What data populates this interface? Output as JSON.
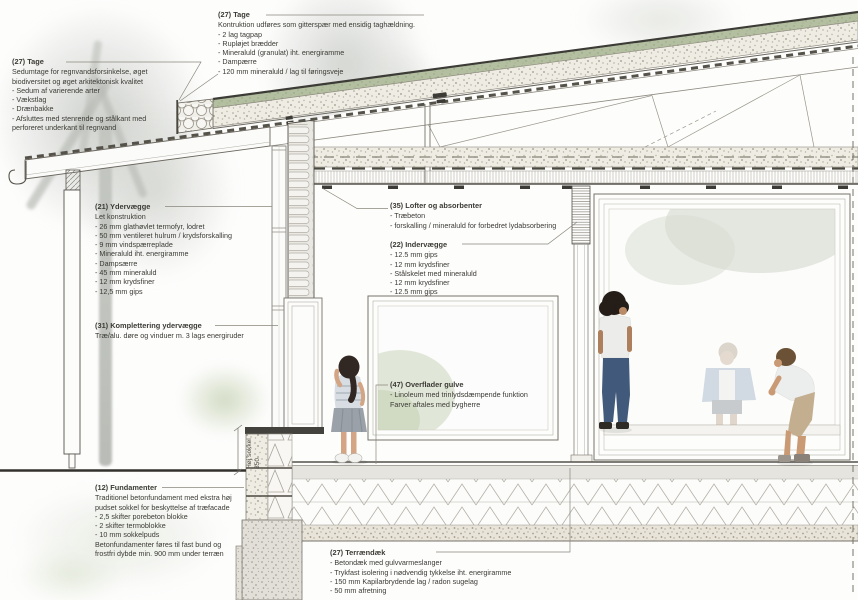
{
  "meta": {
    "drawing_type": "architectural facade section detail",
    "language": "da"
  },
  "palette": {
    "line_dark": "#55524a",
    "sedum_green": "#b3bfa0",
    "insulation_beige": "#efece3",
    "concrete_gray": "#e2dfd8",
    "watercolor_gray": "#c6c9c4",
    "foliage_green": "#ccd6bb",
    "denim_blue": "#41597a"
  },
  "annotations": {
    "tage_construction": {
      "title": "(27) Tage",
      "body": "Kontruktion udføres som gitterspær med ensidig taghældning.\n- 2 lag tagpap\n- Rupløjet brædder\n- Mineraluld (granulat) iht. energiramme\n- Dampærre\n- 120 mm mineraluld / lag til føringsveje"
    },
    "tage_sedum": {
      "title": "(27) Tage",
      "body": "Sedumtage for regnvandsforsinkelse, øget\nbiodiversitet og øget arkitektonisk kvalitet\n- Sedum af varierende arter\n- Vækstlag\n- Drænbakke\n- Afsluttes med stenrende og stålkant med\nperforeret underkant til regnvand"
    },
    "ydervaegge": {
      "title": "(21) Ydervægge",
      "body": "Let konstruktion\n- 26 mm glathøvlet termofyr, lodret\n- 50 mm ventileret hulrum / krydsforskalling\n- 9 mm vindspærreplade\n- Mineraluld iht. energiramme\n- Dampsærre\n- 45 mm mineraluld\n- 12 mm krydsfiner\n- 12,5 mm gips"
    },
    "komplettering_ydervaegge": {
      "title": "(31) Komplettering ydervægge",
      "body": "Træ/alu. døre og vinduer m. 3 lags energiruder"
    },
    "fundamenter": {
      "title": "(12) Fundamenter",
      "body": "Traditionel betonfundament med ekstra høj\npudset sokkel for beskyttelse af træfacade\n- 2,5 skifter porebeton blokke\n- 2 skifter termoblokke\n- 10 mm sokkelpuds\nBetonfundamenter føres til fast bund og\nfrostfri dybde min. 900 mm under terræn"
    },
    "lofter_absorbenter": {
      "title": "(35) Lofter og absorbenter",
      "body": "- Træbeton\n- forskalling / mineraluld for forbedret lydabsorbering"
    },
    "indervaegge": {
      "title": "(22) Indervægge",
      "body": "- 12.5 mm gips\n- 12 mm krydsfiner\n- Stålskelet med mineraluld\n- 12 mm krydsfiner\n- 12.5 mm gips"
    },
    "overflader_gulve": {
      "title": "(47) Overflader gulve",
      "body": "- Linoleum med trinlydsdæmpende funktion\nFarver aftales med bygherre"
    },
    "terraendaek": {
      "title": "(27) Terrændæk",
      "body": "- Betondæk med gulvvarmeslanger\n- Trykfast isolering i nødvendig tykkelse iht. energiramme\n- 150 mm Kapilarbrydende lag / radon sugelag\n- 50 mm afretning"
    }
  },
  "dimensions": {
    "hoej_sokkel": {
      "label": "Høj sokkel",
      "value": "350"
    }
  }
}
